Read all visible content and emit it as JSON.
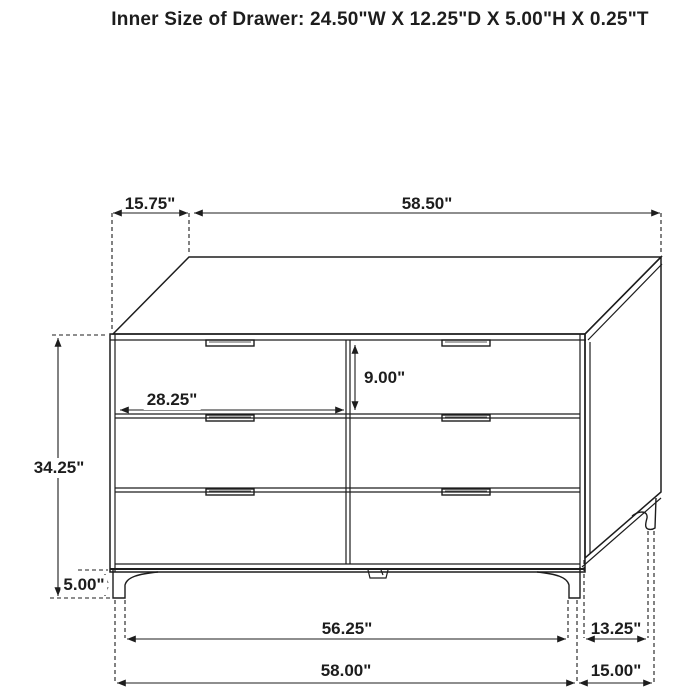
{
  "colors": {
    "background": "#ffffff",
    "line": "#1d1d1d"
  },
  "title": "Inner Size of Drawer: 24.50\"W X 12.25\"D X 5.00\"H X 0.25\"T",
  "subject": "six-drawer-dresser-dimension-drawing",
  "dimensions": {
    "top_depth": "15.75\"",
    "top_width": "58.50\"",
    "overall_height": "34.25\"",
    "drawer_width": "28.25\"",
    "drawer_height": "9.00\"",
    "leg_height": "5.00\"",
    "front_leg_span": "56.25\"",
    "side_leg_span": "13.25\"",
    "overall_width": "58.00\"",
    "overall_depth": "15.00\""
  }
}
